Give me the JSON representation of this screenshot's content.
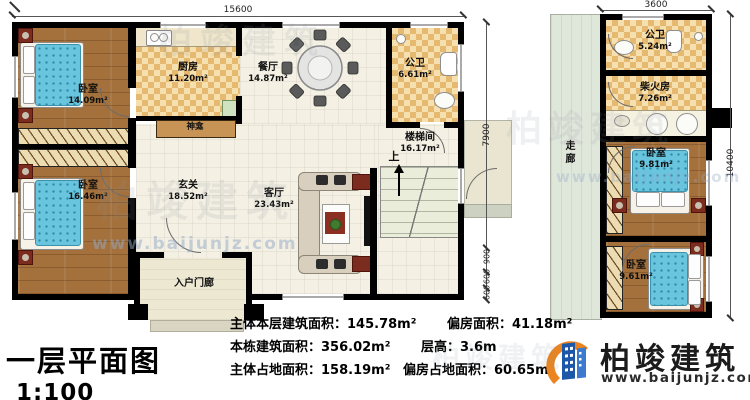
{
  "meta": {
    "title": "一层平面图",
    "scale": "1:100",
    "up": "上"
  },
  "brand": {
    "name": "柏竣建筑",
    "url": "www.baijunjz.com"
  },
  "watermark": {
    "name": "柏竣建筑",
    "url": "www.baijunjz.com"
  },
  "main_rooms": {
    "bedroom1": {
      "name": "卧室",
      "area": "14.09m²"
    },
    "bedroom2": {
      "name": "卧室",
      "area": "16.46m²"
    },
    "kitchen": {
      "name": "厨房",
      "area": "11.20m²"
    },
    "dining": {
      "name": "餐厅",
      "area": "14.87m²"
    },
    "bath": {
      "name": "公卫",
      "area": "6.61m²"
    },
    "stairwell": {
      "name": "楼梯间",
      "area": "16.17m²"
    },
    "foyer": {
      "name": "玄关",
      "area": "18.52m²"
    },
    "living": {
      "name": "客厅",
      "area": "23.43m²"
    },
    "porch": {
      "name": "入户门廊"
    },
    "shrine": {
      "name": "神龛"
    }
  },
  "side_rooms": {
    "bath": {
      "name": "公卫",
      "area": "5.24m²"
    },
    "firewood": {
      "name": "柴火房",
      "area": "7.26m²"
    },
    "bedroomA": {
      "name": "卧室",
      "area": "9.81m²"
    },
    "bedroomB": {
      "name": "卧室",
      "area": "9.61m²"
    },
    "corridor": {
      "name": "走廊"
    }
  },
  "dimensions": {
    "main_top": "15600",
    "side_top": "3600",
    "main_right_total": "7900",
    "main_right_segs": [
      "900",
      "600",
      "600"
    ],
    "side_right": "10400"
  },
  "stats": {
    "items": [
      {
        "label": "主体本层建筑面积：",
        "value": "145.78m²"
      },
      {
        "label": "偏房面积：",
        "value": "41.18m²"
      },
      {
        "label": "本栋建筑面积：",
        "value": "356.02m²"
      },
      {
        "label": "层高：",
        "value": "3.6m"
      },
      {
        "label": "主体占地面积：",
        "value": "158.19m²"
      },
      {
        "label": "偏房占地面积：",
        "value": "60.65m²"
      }
    ]
  },
  "colors": {
    "wall": "#000000",
    "wood": "#a4713c",
    "tile": "#e5b96f",
    "bed": "#69c4de",
    "accent_red": "#7b2c1f",
    "logo_blue": "#1d57a8",
    "logo_orange": "#e98420"
  }
}
